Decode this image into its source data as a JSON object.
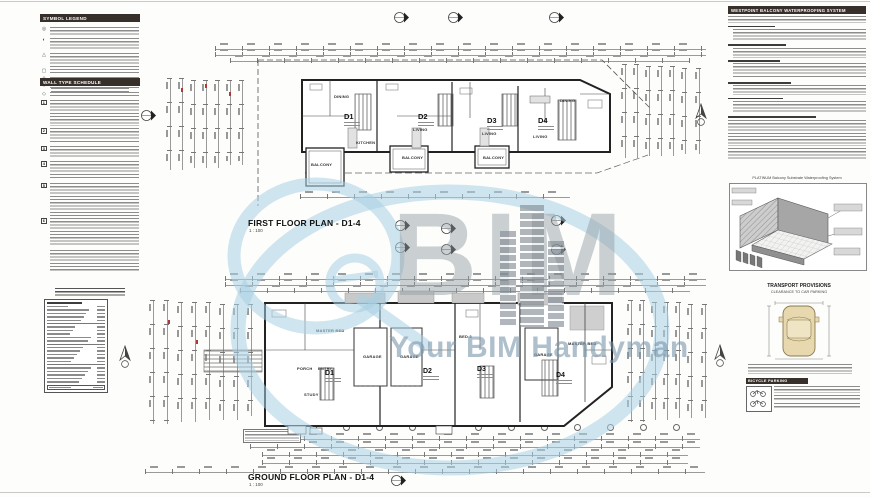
{
  "titles": {
    "first_floor": "FIRST FLOOR PLAN - D1-4",
    "first_floor_scale": "1 : 100",
    "ground_floor": "GROUND FLOOR PLAN - D1-4",
    "ground_floor_scale": "1 : 100"
  },
  "left_panel": {
    "symbol_legend": "SYMBOL LEGEND",
    "wall_type_schedule": "WALL TYPE SCHEDULE",
    "wall_type_numbers": [
      "1",
      "2",
      "3",
      "4",
      "5",
      "6"
    ]
  },
  "right_panel": {
    "waterproofing_header": "WESTPOINT BALCONY WATERPROOFING SYSTEM",
    "waterproofing_caption": "PLATINUM Balcony Substrate Waterproofing System",
    "transport_header": "TRANSPORT PROVISIONS",
    "transport_sub": "CLEARANCE TO CAR PARKING",
    "bicycle_header": "BICYCLE PARKING"
  },
  "first_floor": {
    "units": [
      "D1",
      "D2",
      "D3",
      "D4"
    ],
    "rooms": {
      "balcony1": "BALCONY",
      "kitchen": "KITCHEN",
      "dining1": "DINING",
      "living2": "LIVING",
      "balcony2": "BALCONY",
      "living3": "LIVING",
      "balcony3": "BALCONY",
      "living4": "LIVING",
      "dining4": "DINING"
    }
  },
  "ground_floor": {
    "units": [
      "D1",
      "D2",
      "D3",
      "D4"
    ],
    "rooms": {
      "master1": "MASTER BED",
      "garage1": "GARAGE",
      "garage2": "GARAGE",
      "garage3": "GARAGE",
      "porch": "PORCH",
      "entry": "ENTRY",
      "study": "STUDY",
      "bed3": "BED 3",
      "master4": "MASTER BED"
    }
  },
  "watermark": {
    "qe": "Qe",
    "bim": "BIM",
    "tagline": "Your BIM Handyman"
  },
  "colors": {
    "accent_blue": "#a9cfe2",
    "logo_gray": "#949da4",
    "header_dark": "#372f2a",
    "car_tan": "#e7d8b0",
    "line_dark": "#222222"
  }
}
